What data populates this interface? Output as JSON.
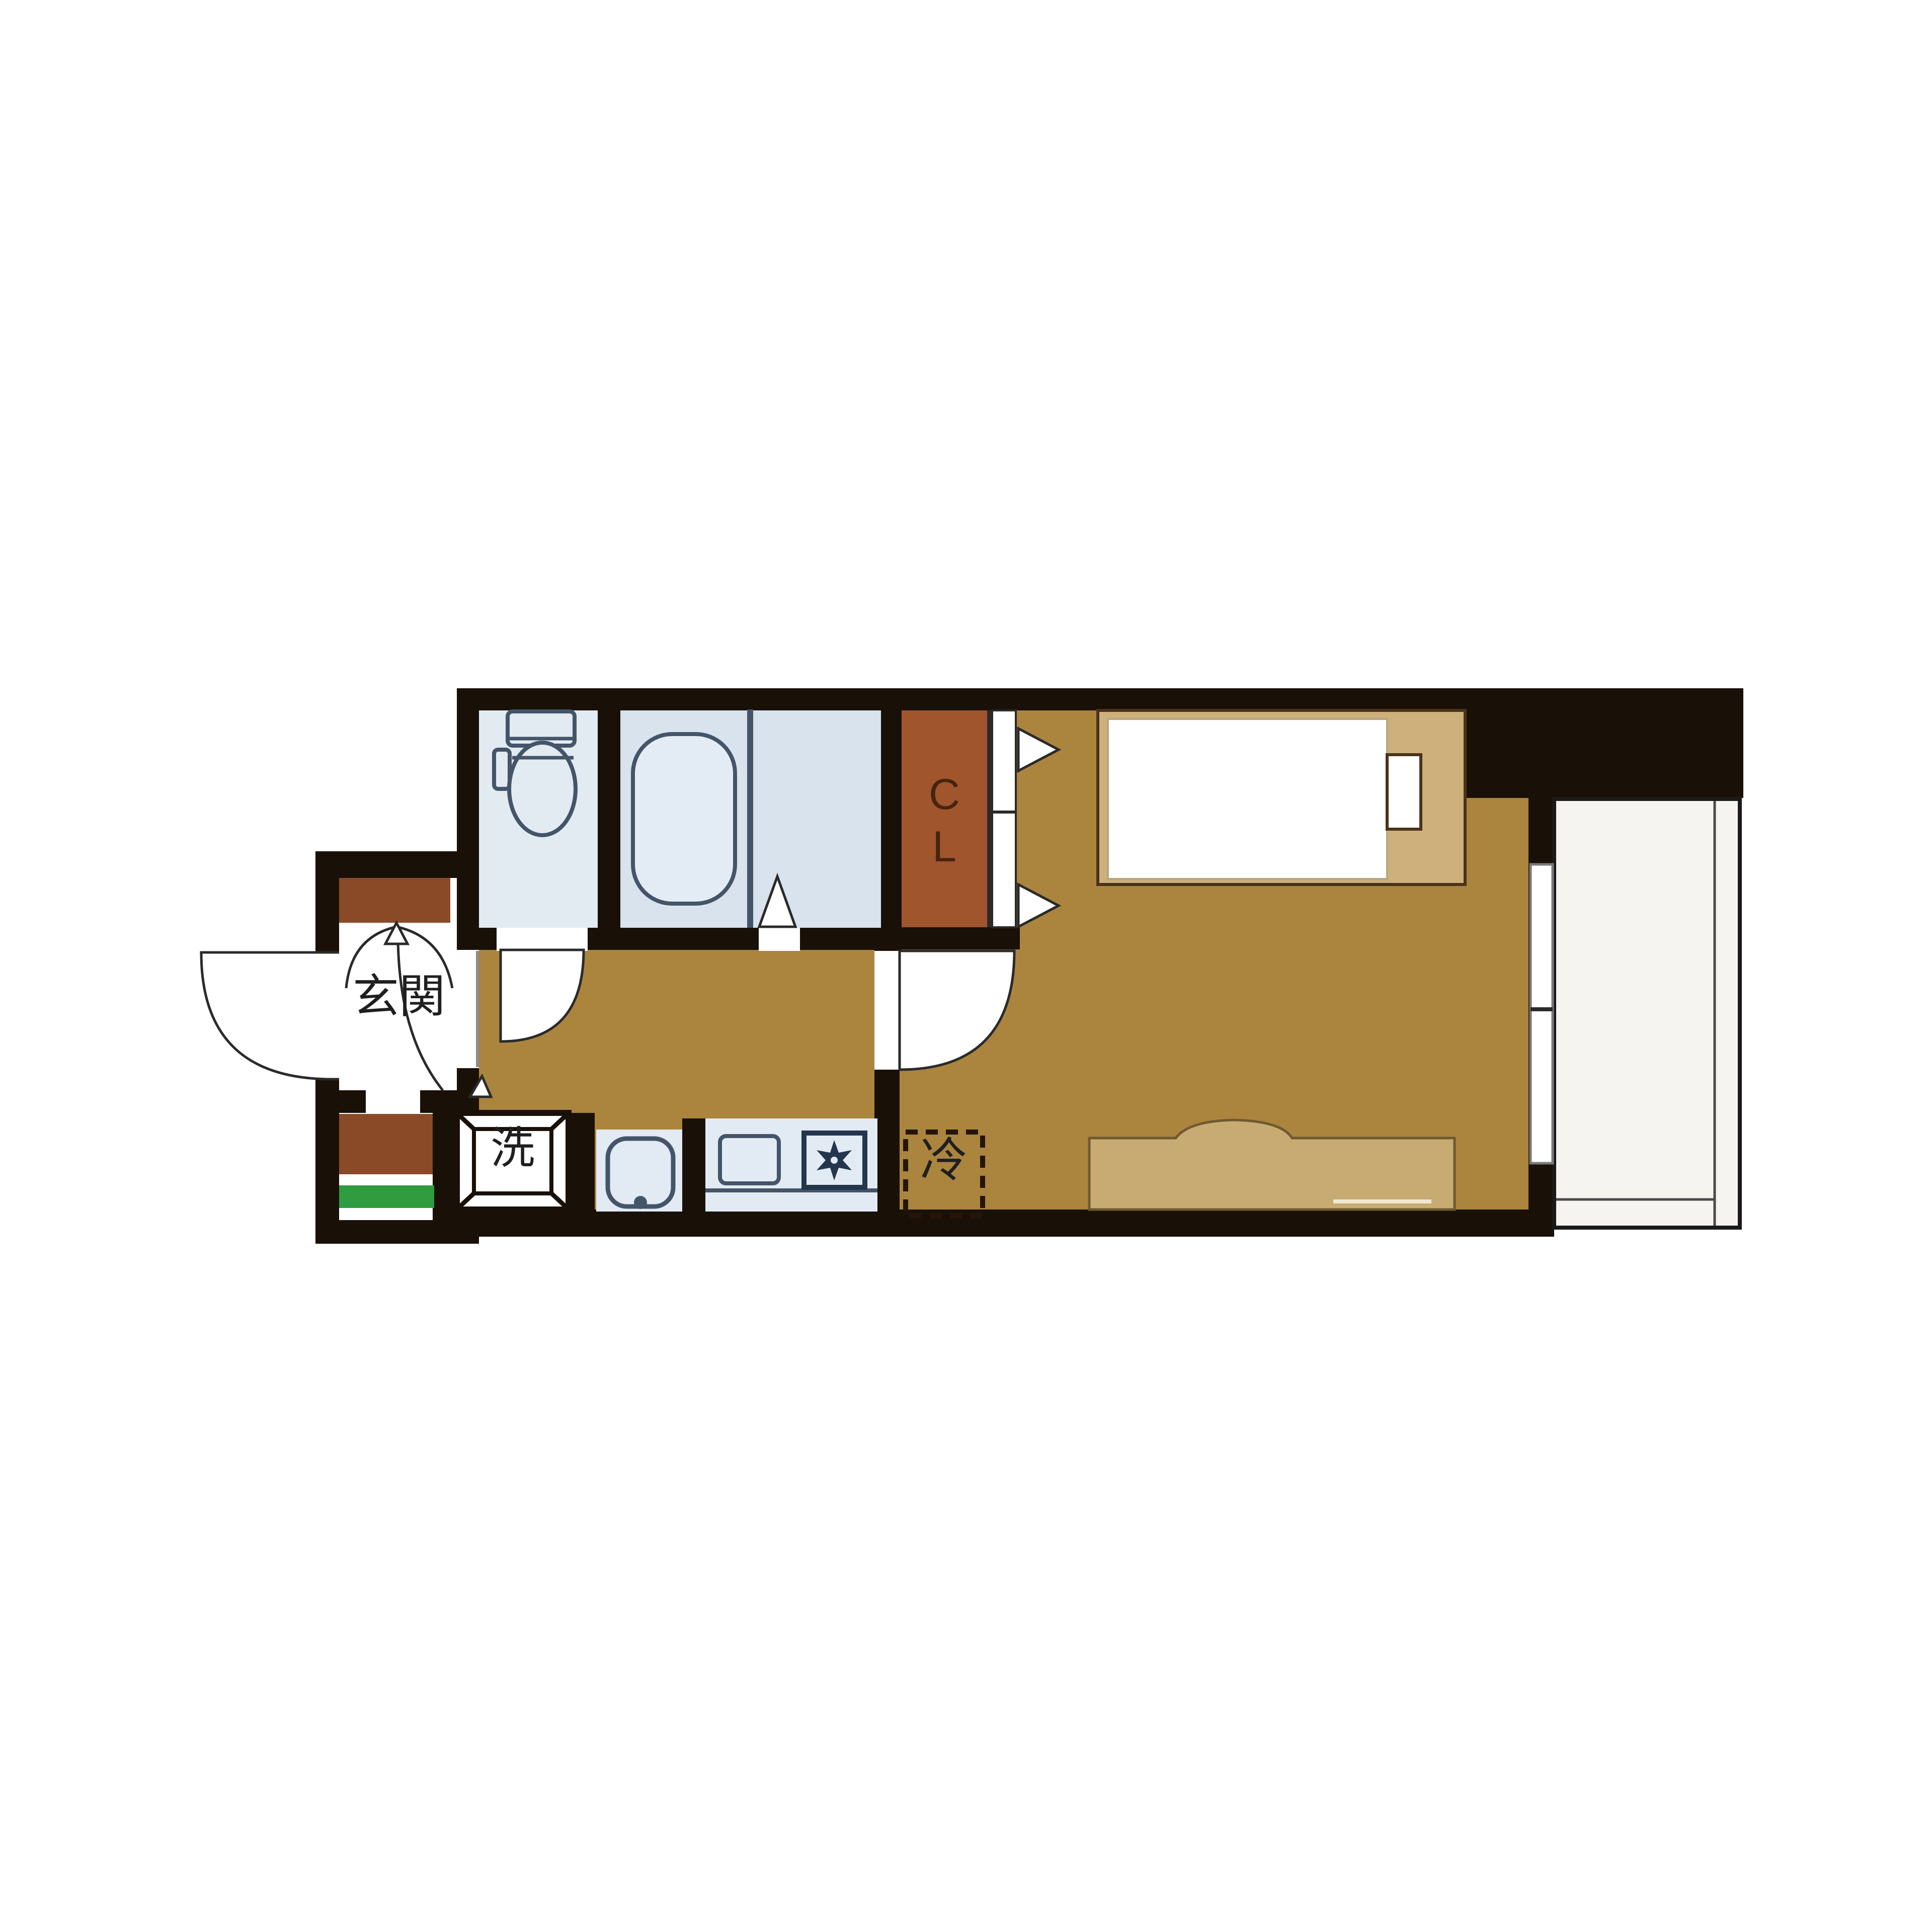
{
  "plan": {
    "type": "apartment-floorplan",
    "labels": {
      "entrance": "玄関",
      "closet_c": "C",
      "closet_l": "L",
      "washer": "洗",
      "fridge": "冷"
    },
    "rooms": [
      {
        "id": "entrance",
        "label": "玄関",
        "meaning": "entrance"
      },
      {
        "id": "toilet",
        "label": "",
        "meaning": "toilet room"
      },
      {
        "id": "bath",
        "label": "",
        "meaning": "unit bath"
      },
      {
        "id": "closet",
        "label": "CL",
        "meaning": "closet"
      },
      {
        "id": "washer-pan",
        "label": "洗",
        "meaning": "washing machine"
      },
      {
        "id": "kitchen",
        "label": "",
        "meaning": "kitchen counter"
      },
      {
        "id": "refrigerator",
        "label": "冷",
        "meaning": "refrigerator space"
      },
      {
        "id": "main-room",
        "label": "",
        "meaning": "western-style room"
      },
      {
        "id": "balcony",
        "label": "",
        "meaning": "balcony"
      }
    ],
    "colors": {
      "wall": "#191008",
      "floor": "#ab843e",
      "bed_frame": "#cdb07c",
      "sofa": "#c8ab73",
      "closet": "#a1552d",
      "cabinet": "#8a4a27",
      "mat": "#2f9c40",
      "toilet_room": "#e2eaf2",
      "bath_room": "#d9e3ee",
      "tub": "#e3ecf4",
      "counter": "#e2eaf3",
      "balcony": "#f5f4f1",
      "white": "#ffffff",
      "fixture_stroke": "#44556a",
      "text_dark": "#1f1f1f",
      "closet_text": "#46250f"
    }
  }
}
